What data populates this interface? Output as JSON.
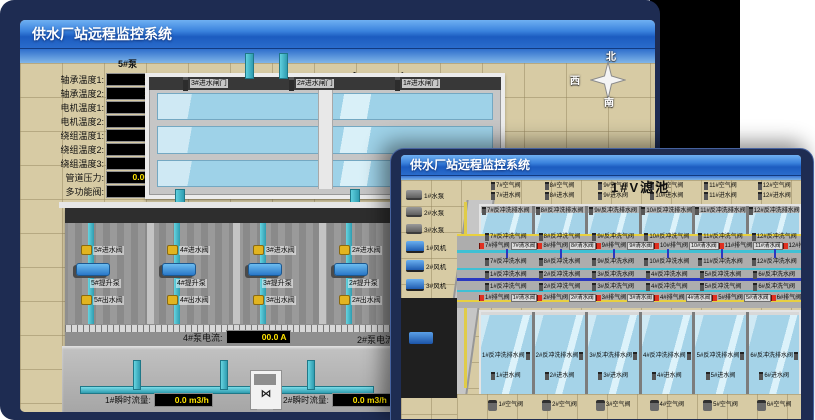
{
  "colors": {
    "frame_navy": "#1e2c52",
    "titlebar_top": "#6fb0f2",
    "titlebar_bottom": "#1c5cc0",
    "value_text": "#ffe400",
    "scene_tan": "#d7cba4",
    "pipe_cyan": "#3fb6c9",
    "alarm_red": "#e03020",
    "water": "#a5d3e8"
  },
  "back": {
    "title": "供水厂站远程监控系统",
    "scene_title": "取水泵房",
    "compass": {
      "n": "北",
      "w": "西",
      "s": "南",
      "e": "东"
    },
    "right_labels": [
      "轴承温度1:",
      "轴承温度2:"
    ],
    "panel": {
      "header": "5#泵",
      "rows": [
        {
          "label": "轴承温度1:",
          "value": "100.0℃"
        },
        {
          "label": "轴承温度2:",
          "value": "100.0℃"
        },
        {
          "label": "电机温度1:",
          "value": "18.1℃"
        },
        {
          "label": "电机温度2:",
          "value": "17.9℃"
        },
        {
          "label": "绕组温度1:",
          "value": "18.0℃"
        },
        {
          "label": "绕组温度2:",
          "value": "18.1℃"
        },
        {
          "label": "绕组温度3:",
          "value": "18.1℃"
        },
        {
          "label": "管道压力:",
          "value": "0.0007MPa"
        },
        {
          "label": "多功能阀:",
          "value": "0%"
        }
      ]
    },
    "gate_valves": [
      "3#进水闸门",
      "2#进水闸门",
      "1#进水闸门"
    ],
    "bay_numbers": [
      "5#",
      "4#",
      "3#",
      "2#"
    ],
    "bays": [
      {
        "inlet": "5#进水阀",
        "pump": "5#提升泵",
        "outlet": "5#出水阀"
      },
      {
        "inlet": "4#进水阀",
        "pump": "4#提升泵",
        "outlet": "4#出水阀"
      },
      {
        "inlet": "3#进水阀",
        "pump": "3#提升泵",
        "outlet": "3#出水阀"
      },
      {
        "inlet": "2#进水阀",
        "pump": "2#提升泵",
        "outlet": "2#出水阀"
      }
    ],
    "current_meters": [
      {
        "label": "4#泵电流:",
        "value": "00.0 A"
      },
      {
        "label": "2#泵电流:",
        "value": "00.0 A"
      }
    ],
    "flow_meters": [
      {
        "label": "1#瞬时流量:",
        "value": "0.0 m3/h"
      },
      {
        "label": "2#瞬时流量:",
        "value": "0.0 m3/h"
      }
    ]
  },
  "front": {
    "title": "供水厂站远程监控系统",
    "scene_title": "1#V滤池",
    "equipment": {
      "pumps": [
        "1#水泵",
        "2#水泵",
        "3#水泵"
      ],
      "blowers": [
        "1#风机",
        "2#风机",
        "3#风机"
      ]
    },
    "top": {
      "air": [
        "7#空气阀",
        "8#空气阀",
        "9#空气阀",
        "10#空气阀",
        "11#空气阀",
        "12#空气阀"
      ],
      "inlet": [
        "7#进水阀",
        "8#进水阀",
        "9#进水阀",
        "10#进水阀",
        "11#进水阀",
        "12#进水阀"
      ],
      "drain": [
        "7#反冲洗排水阀",
        "8#反冲洗排水阀",
        "9#反冲洗排水阀",
        "10#反冲洗排水阀",
        "11#反冲洗排水阀",
        "12#反冲洗排水阀"
      ]
    },
    "corridor": {
      "bw_air_top": [
        "7#反冲洗气阀",
        "8#反冲洗气阀",
        "9#反冲洗气阀",
        "10#反冲洗气阀",
        "11#反冲洗气阀",
        "12#反冲洗气阀"
      ],
      "exhaust_top": [
        {
          "e": "7#排气阀",
          "c": "7#清水阀"
        },
        {
          "e": "8#排气阀",
          "c": "8#清水阀"
        },
        {
          "e": "9#排气阀",
          "c": "9#清水阀"
        },
        {
          "e": "10#排气阀",
          "c": "10#清水阀"
        },
        {
          "e": "11#排气阀",
          "c": "11#清水阀"
        },
        {
          "e": "12#排气阀",
          "c": "12#清水阀"
        }
      ],
      "bw_water_top": [
        "7#反冲洗水阀",
        "8#反冲洗水阀",
        "9#反冲洗水阀",
        "10#反冲洗水阀",
        "11#反冲洗水阀",
        "12#反冲洗水阀"
      ],
      "bw_water_bottom": [
        "1#反冲洗水阀",
        "2#反冲洗水阀",
        "3#反冲洗水阀",
        "4#反冲洗水阀",
        "5#反冲洗水阀",
        "6#反冲洗水阀"
      ],
      "bw_air_bottom": [
        "1#反冲洗气阀",
        "2#反冲洗气阀",
        "3#反冲洗气阀",
        "4#反冲洗气阀",
        "5#反冲洗气阀",
        "6#反冲洗气阀"
      ],
      "exhaust_bottom": [
        {
          "e": "1#排气阀",
          "c": "1#清水阀"
        },
        {
          "e": "2#排气阀",
          "c": "2#清水阀"
        },
        {
          "e": "3#排气阀",
          "c": "3#清水阀"
        },
        {
          "e": "4#排气阀",
          "c": "4#清水阀"
        },
        {
          "e": "5#排气阀",
          "c": "5#清水阀"
        },
        {
          "e": "6#排气阀",
          "c": "6#清水阀"
        }
      ]
    },
    "bottom": {
      "drain": [
        "1#反冲洗排水阀",
        "2#反冲洗排水阀",
        "3#反冲洗排水阀",
        "4#反冲洗排水阀",
        "5#反冲洗排水阀",
        "6#反冲洗排水阀"
      ],
      "inlet": [
        "1#进水阀",
        "2#进水阀",
        "3#进水阀",
        "4#进水阀",
        "5#进水阀",
        "6#进水阀"
      ],
      "air": [
        "1#空气阀",
        "2#空气阀",
        "3#空气阀",
        "4#空气阀",
        "5#空气阀",
        "6#空气阀"
      ]
    }
  }
}
